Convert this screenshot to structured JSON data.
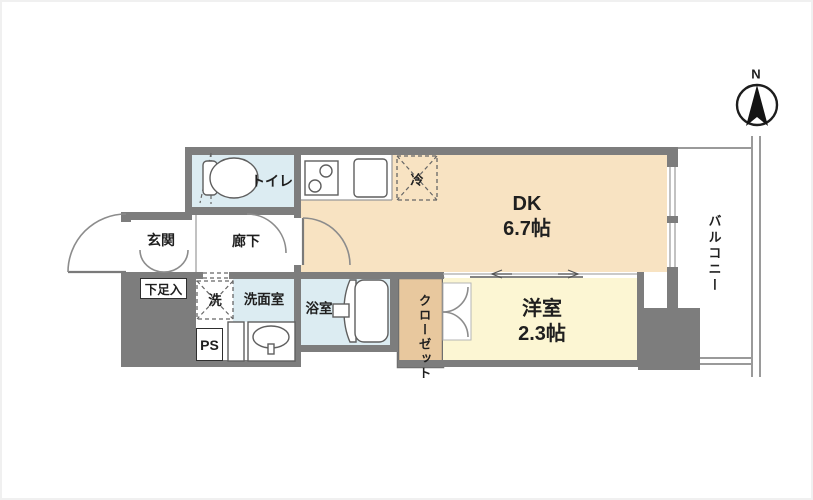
{
  "plan": {
    "compass": {
      "north_label": "N"
    },
    "rooms": {
      "toilet": "トイレ",
      "entrance": "玄関",
      "shoe_cabinet": "下足入",
      "hallway": "廊下",
      "laundry": "洗",
      "washroom": "洗面室",
      "pipe_space": "PS",
      "bathroom": "浴室",
      "refrigerator": "冷",
      "dk_label": "DK",
      "dk_size": "6.7帖",
      "western_room_label": "洋室",
      "western_room_size": "2.3帖",
      "closet": "クローゼット",
      "balcony": "バルコニー"
    },
    "colors": {
      "wall": "#7d7d7d",
      "dk_floor": "#f8e3c2",
      "western_floor": "#fcf6d3",
      "wet_area": "#dcecf2",
      "closet_fill": "#e8c89e"
    }
  }
}
